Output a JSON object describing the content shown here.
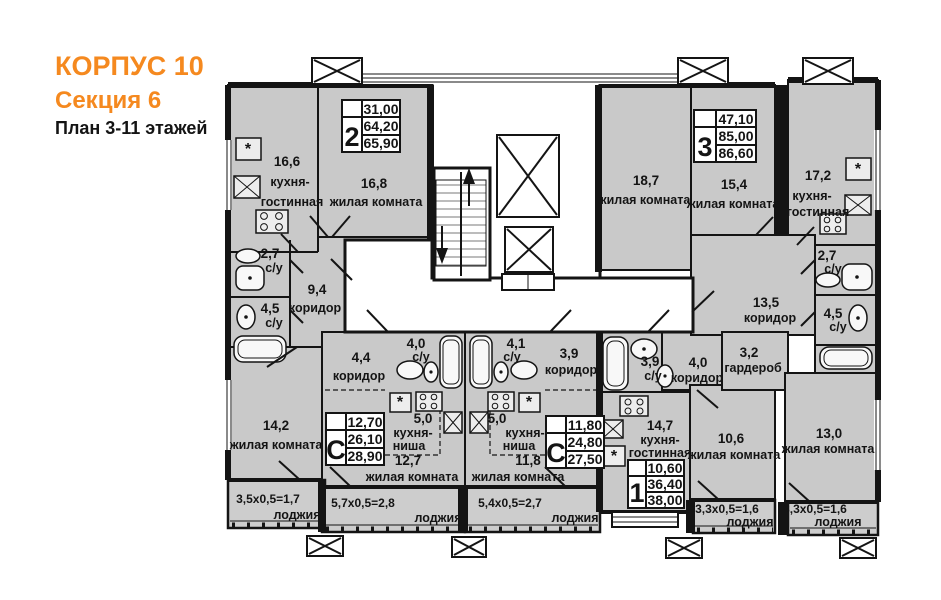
{
  "header": {
    "building": "КОРПУС 10",
    "section": "Секция 6",
    "floors": "План 3-11 этажей"
  },
  "colors": {
    "accent": "#F5891F",
    "wall": "#141414",
    "room_fill": "#C9C9C9"
  },
  "symbols": {
    "star": "*"
  },
  "apartments": {
    "two_room": {
      "badge": "2",
      "stats": [
        "31,00",
        "64,20",
        "65,90"
      ],
      "rooms": {
        "kitchen_living": {
          "area": "16,6",
          "name1": "кухня-",
          "name2": "гостинная"
        },
        "living_a": {
          "area": "16,8",
          "name": "жилая комната"
        },
        "wc_small": {
          "area": "2,7",
          "name": "с/у"
        },
        "corridor": {
          "area": "9,4",
          "name": "коридор"
        },
        "wc_large": {
          "area": "4,5",
          "name": "с/у"
        },
        "living_b": {
          "area": "14,2",
          "name": "жилая комната"
        },
        "loggia": {
          "calc": "3,5х0,5=1,7",
          "name": "лоджия"
        }
      }
    },
    "studio_left": {
      "badge": "С",
      "stats": [
        "12,70",
        "26,10",
        "28,90"
      ],
      "rooms": {
        "corridor": {
          "area": "4,4",
          "name": "коридор"
        },
        "wc": {
          "area": "4,0",
          "name": "с/у"
        },
        "kitchen_niche": {
          "area": "5,0",
          "name1": "кухня-",
          "name2": "ниша"
        },
        "living": {
          "area": "12,7",
          "name": "жилая комната"
        },
        "loggia": {
          "calc": "5,7х0,5=2,8",
          "name": "лоджия"
        }
      }
    },
    "studio_right": {
      "badge": "С",
      "stats": [
        "11,80",
        "24,80",
        "27,50"
      ],
      "rooms": {
        "wc": {
          "area": "4,1",
          "name": "с/у"
        },
        "corridor": {
          "area": "3,9",
          "name": "коридор"
        },
        "kitchen_niche": {
          "area": "5,0",
          "name1": "кухня-",
          "name2": "ниша"
        },
        "living": {
          "area": "11,8",
          "name": "жилая комната"
        },
        "loggia": {
          "calc": "5,4х0,5=2,7",
          "name": "лоджия"
        }
      }
    },
    "one_room": {
      "badge": "1",
      "stats": [
        "10,60",
        "36,40",
        "38,00"
      ],
      "rooms": {
        "wc": {
          "area": "3,9",
          "name": "с/у"
        },
        "corridor": {
          "area": "4,0",
          "name": "коридор"
        },
        "kitchen_living": {
          "area": "14,7",
          "name1": "кухня-",
          "name2": "гостинная"
        },
        "living": {
          "area": "10,6",
          "name": "жилая комната"
        },
        "loggia": {
          "calc": "3,3х0,5=1,6",
          "name": "лоджия"
        }
      }
    },
    "three_room": {
      "badge": "3",
      "stats": [
        "47,10",
        "85,00",
        "86,60"
      ],
      "rooms": {
        "living_a": {
          "area": "18,7",
          "name": "жилая комната"
        },
        "living_b": {
          "area": "15,4",
          "name": "жилая комната"
        },
        "kitchen_living": {
          "area": "17,2",
          "name1": "кухня-",
          "name2": "гостинная"
        },
        "wc_small": {
          "area": "2,7",
          "name": "с/у"
        },
        "corridor": {
          "area": "13,5",
          "name": "коридор"
        },
        "wc_large": {
          "area": "4,5",
          "name": "с/у"
        },
        "wardrobe": {
          "area": "3,2",
          "name": "гардероб"
        },
        "living_c": {
          "area": "13,0",
          "name": "жилая комната"
        },
        "loggia": {
          "calc": "3,3х0,5=1,6",
          "name": "лоджия"
        }
      }
    }
  }
}
